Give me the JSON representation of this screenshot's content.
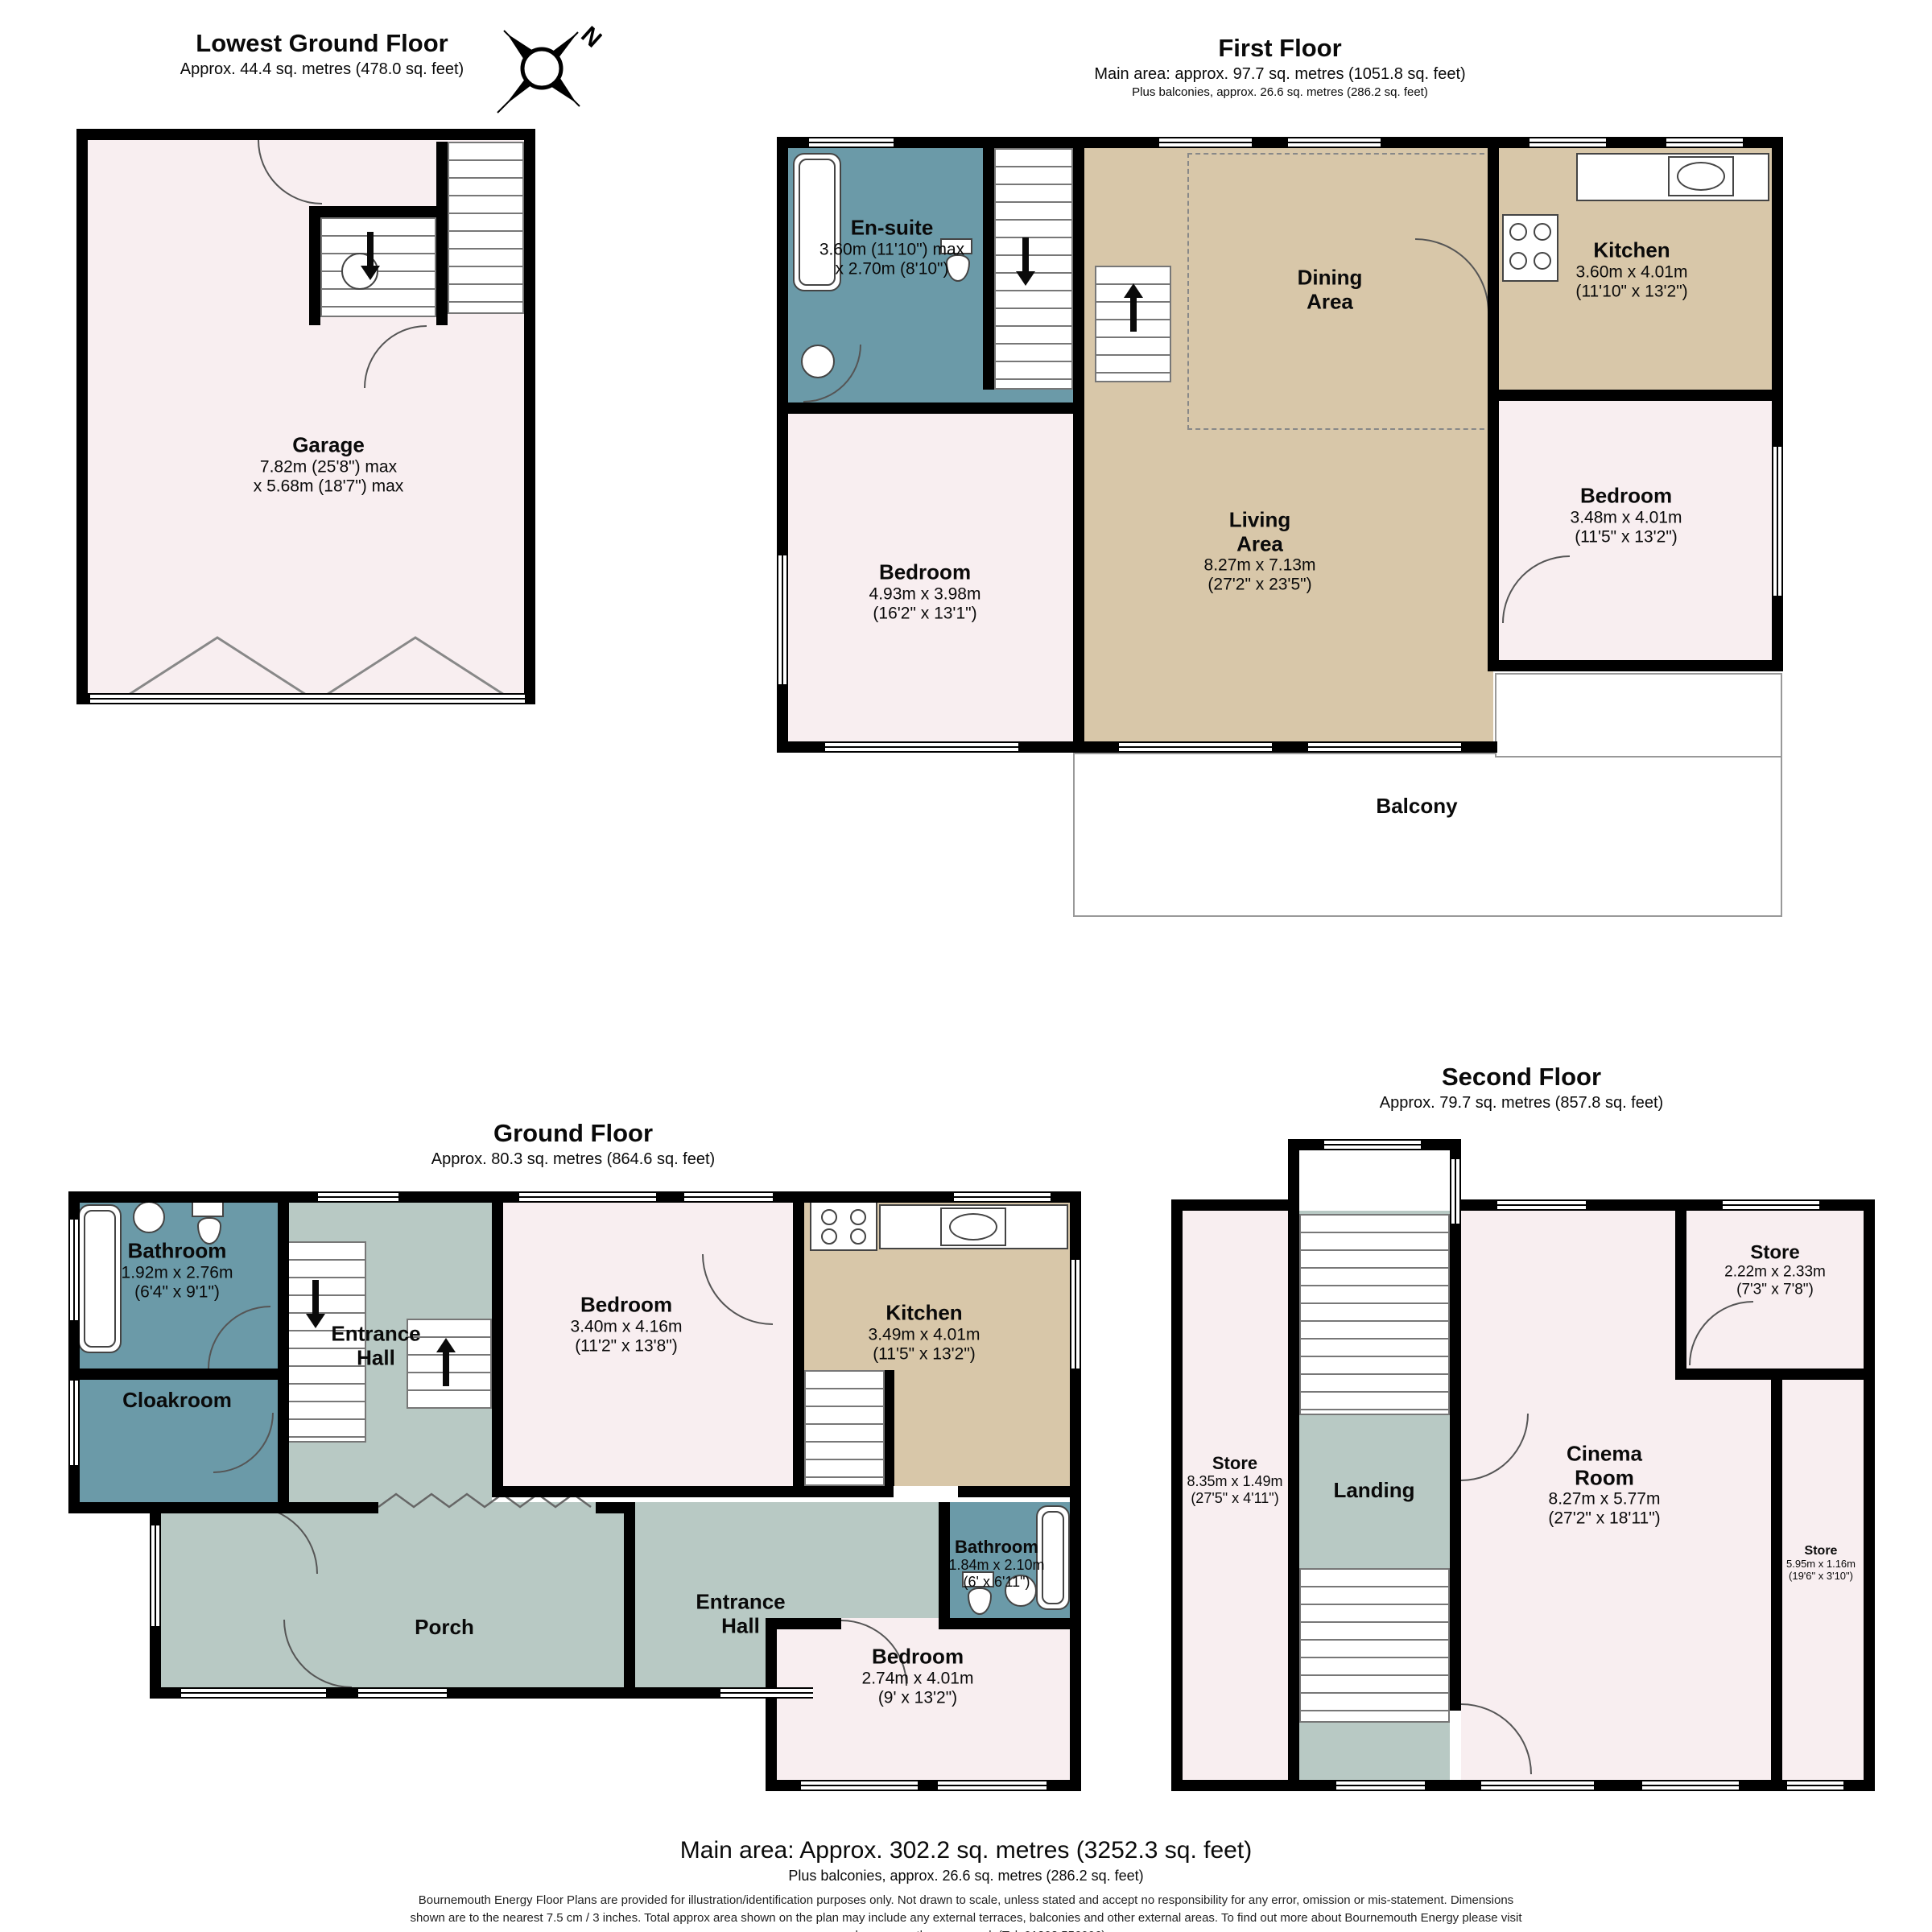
{
  "colors": {
    "room_pink": "#f8eef0",
    "room_tan": "#d8c7a9",
    "room_teal": "#6b9aa8",
    "room_hall": "#b8c9c4",
    "wall": "#000000",
    "balcony_outline": "#999999"
  },
  "compass": {
    "label": "N"
  },
  "floors": {
    "lowest_ground": {
      "title": "Lowest Ground Floor",
      "subtitle": "Approx. 44.4 sq. metres (478.0 sq. feet)",
      "rooms": {
        "garage": {
          "name": "Garage",
          "dim1": "7.82m (25'8\") max",
          "dim2": "x 5.68m (18'7\") max"
        }
      }
    },
    "first": {
      "title": "First Floor",
      "subtitle": "Main area: approx. 97.7 sq. metres (1051.8 sq. feet)",
      "subtitle2": "Plus balconies, approx. 26.6 sq. metres (286.2 sq. feet)",
      "rooms": {
        "ensuite": {
          "name": "En-suite",
          "dim1": "3.60m (11'10\") max",
          "dim2": "x 2.70m (8'10\")"
        },
        "dining": {
          "name": "Dining",
          "name2": "Area"
        },
        "kitchen": {
          "name": "Kitchen",
          "dim1": "3.60m x 4.01m",
          "dim2": "(11'10\" x 13'2\")"
        },
        "bedroom_left": {
          "name": "Bedroom",
          "dim1": "4.93m x 3.98m",
          "dim2": "(16'2\" x 13'1\")"
        },
        "living": {
          "name": "Living",
          "name2": "Area",
          "dim1": "8.27m x 7.13m",
          "dim2": "(27'2\" x 23'5\")"
        },
        "bedroom_right": {
          "name": "Bedroom",
          "dim1": "3.48m x 4.01m",
          "dim2": "(11'5\" x 13'2\")"
        },
        "balcony": {
          "name": "Balcony"
        }
      }
    },
    "ground": {
      "title": "Ground Floor",
      "subtitle": "Approx. 80.3 sq. metres (864.6 sq. feet)",
      "rooms": {
        "bathroom": {
          "name": "Bathroom",
          "dim1": "1.92m x 2.76m",
          "dim2": "(6'4\" x 9'1\")"
        },
        "cloakroom": {
          "name": "Cloakroom"
        },
        "entrance_hall_upper": {
          "name": "Entrance",
          "name2": "Hall"
        },
        "bedroom": {
          "name": "Bedroom",
          "dim1": "3.40m x 4.16m",
          "dim2": "(11'2\" x 13'8\")"
        },
        "kitchen": {
          "name": "Kitchen",
          "dim1": "3.49m x 4.01m",
          "dim2": "(11'5\" x 13'2\")"
        },
        "porch": {
          "name": "Porch"
        },
        "entrance_hall_lower": {
          "name": "Entrance",
          "name2": "Hall"
        },
        "bathroom_lower": {
          "name": "Bathroom",
          "dim1": "1.84m x 2.10m",
          "dim2": "(6' x 6'11\")"
        },
        "bedroom_lower": {
          "name": "Bedroom",
          "dim1": "2.74m x 4.01m",
          "dim2": "(9' x 13'2\")"
        }
      }
    },
    "second": {
      "title": "Second Floor",
      "subtitle": "Approx. 79.7 sq. metres (857.8 sq. feet)",
      "rooms": {
        "store_top": {
          "name": "Store",
          "dim1": "2.22m x 2.33m",
          "dim2": "(7'3\" x 7'8\")"
        },
        "store_left": {
          "name": "Store",
          "dim1": "8.35m x 1.49m",
          "dim2": "(27'5\" x 4'11\")"
        },
        "landing": {
          "name": "Landing"
        },
        "cinema": {
          "name": "Cinema",
          "name2": "Room",
          "dim1": "8.27m x 5.77m",
          "dim2": "(27'2\" x 18'11\")"
        },
        "store_right": {
          "name": "Store",
          "dim1": "5.95m x 1.16m",
          "dim2": "(19'6\" x 3'10\")"
        }
      }
    }
  },
  "footer": {
    "main": "Main area: Approx. 302.2 sq. metres (3252.3 sq. feet)",
    "sub": "Plus balconies, approx. 26.6 sq. metres (286.2 sq. feet)",
    "disclaimer": [
      "Bournemouth Energy Floor Plans are provided for illustration/identification purposes only. Not drawn to scale, unless stated and accept no responsibility for any error, omission or mis-statement. Dimensions",
      "shown are to the nearest 7.5 cm / 3 inches. Total approx area shown on the plan may include any external terraces, balconies and other external areas. To find out more about Bournemouth Energy please visit",
      "www.bournemouthenergy.co.uk (Tel: 01202 556006)",
      "Plan produced using PlanUp."
    ]
  }
}
